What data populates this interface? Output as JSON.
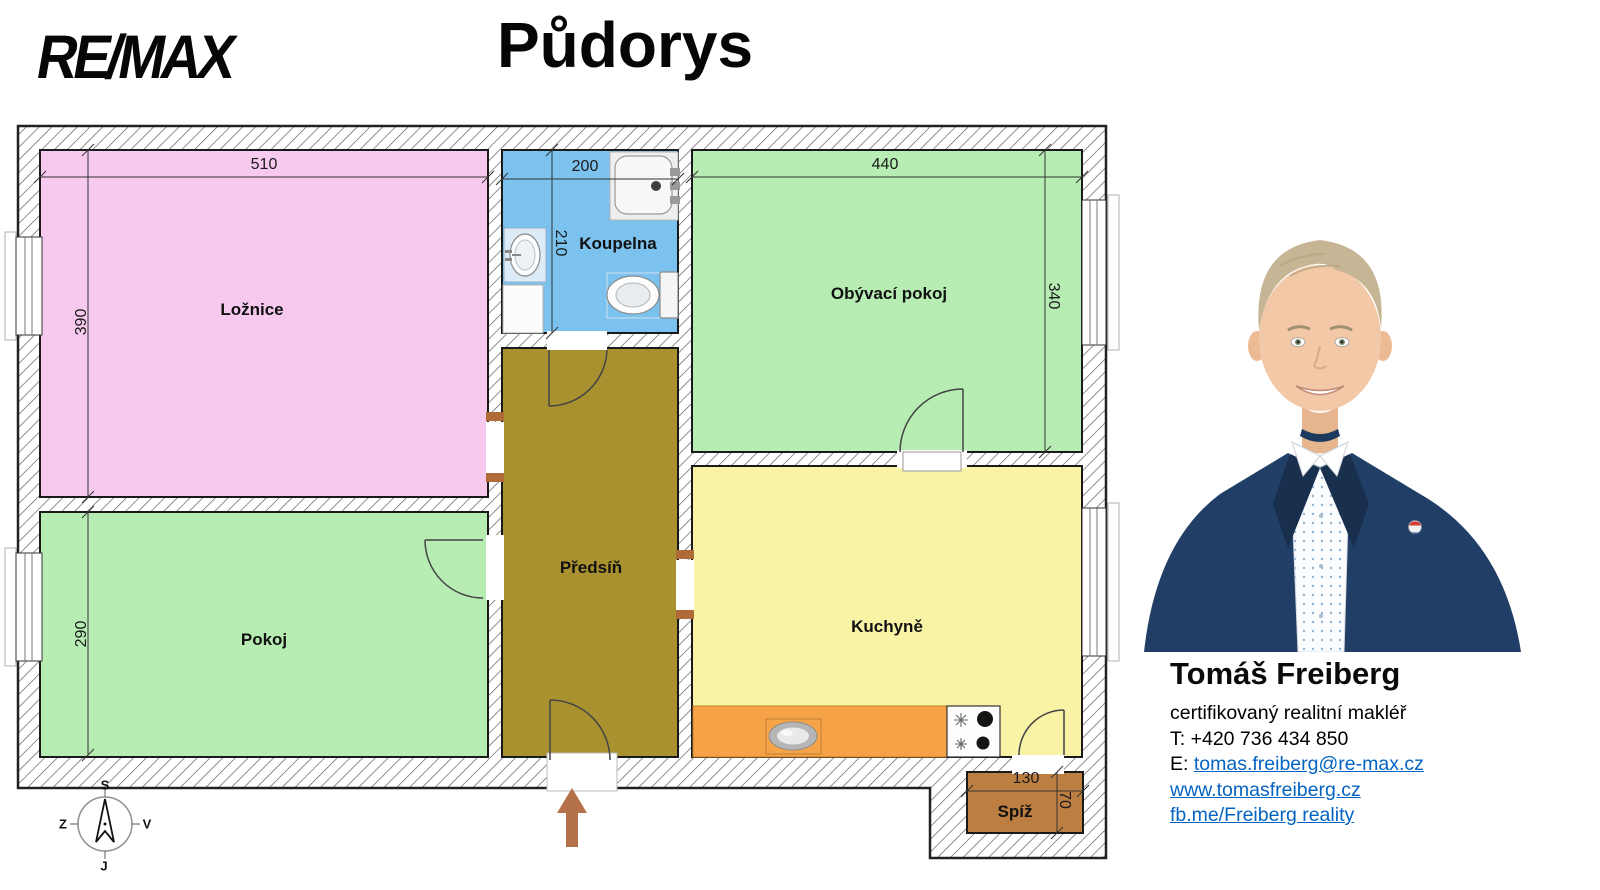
{
  "header": {
    "logo": "RE/MAX",
    "title": "Půdorys"
  },
  "floorplan": {
    "rooms": {
      "loznice": {
        "label": "Ložnice",
        "color": "#F8C9EF",
        "width": "510",
        "height": "390"
      },
      "koupelna": {
        "label": "Koupelna",
        "color": "#7CC2EE",
        "width": "200",
        "height": "210"
      },
      "obyvaci_pokoj": {
        "label": "Obývací pokoj",
        "color": "#B7EDB3",
        "width": "440",
        "height": "340"
      },
      "pokoj": {
        "label": "Pokoj",
        "color": "#B7EDB3",
        "height": "290"
      },
      "predsin": {
        "label": "Předsíň",
        "color": "#A8912E"
      },
      "kuchyne": {
        "label": "Kuchyně",
        "color": "#F9F3A6",
        "counter_color": "#F5A346"
      },
      "spiz": {
        "label": "Spíž",
        "color": "#BD7F41",
        "width": "130",
        "height": "70"
      }
    },
    "compass": {
      "north": "S",
      "east": "V",
      "south": "J",
      "west": "Z"
    },
    "entrance_arrow_color": "#B5714A"
  },
  "agent": {
    "name": "Tomáš Freiberg",
    "role": "certifikovaný realitní makléř",
    "phone_label": "T:",
    "phone": "+420 736 434 850",
    "email_label": "E:",
    "email": "tomas.freiberg@re-max.cz",
    "website": "www.tomasfreiberg.cz",
    "facebook": "fb.me/Freiberg reality",
    "link_color": "#0563C1",
    "suit_color": "#203E66"
  }
}
